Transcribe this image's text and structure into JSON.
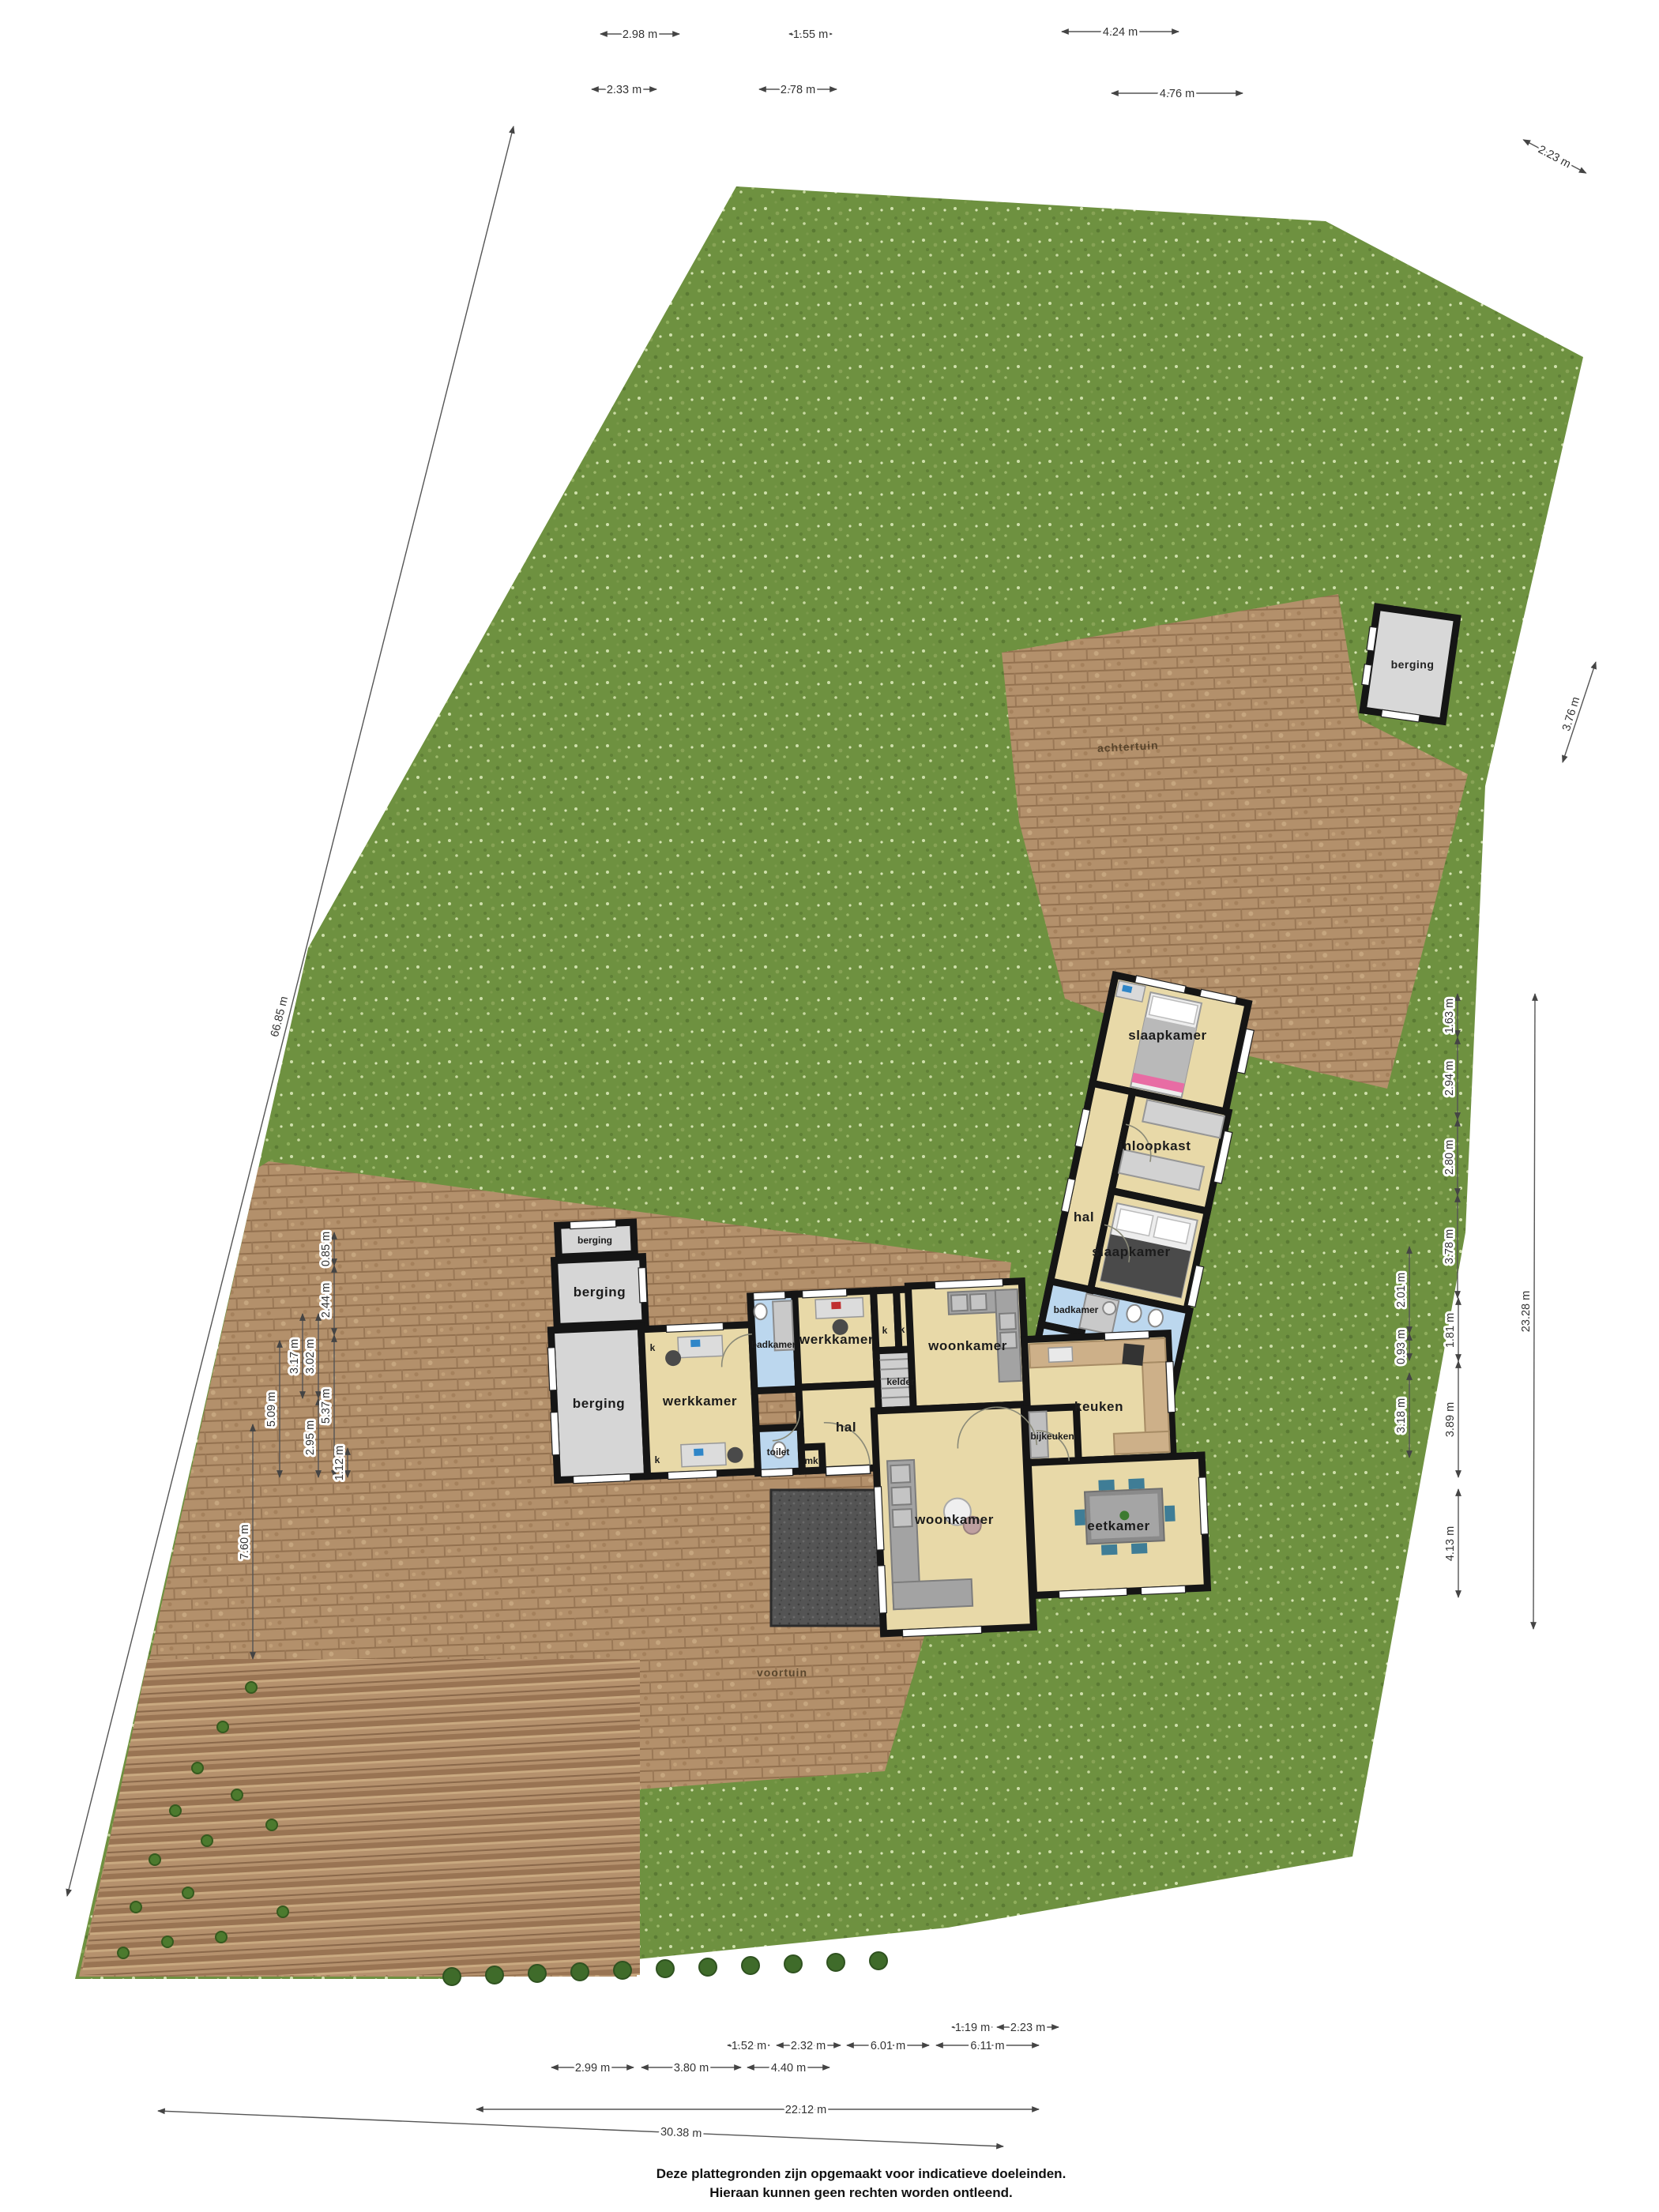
{
  "plan_title": "plattegrond begane grond met tuin",
  "areas": {
    "achtertuin": "achtertuin",
    "voortuin": "voortuin"
  },
  "room_labels": {
    "berging": "berging",
    "werkkamer": "werkkamer",
    "badkamer": "badkamer",
    "kelder": "kelder",
    "hal": "hal",
    "toilet": "toilet",
    "mk": "mk",
    "k": "k",
    "woonkamer": "woonkamer",
    "keuken": "keuken",
    "bijkeuken": "bijkeuken",
    "eetkamer": "eetkamer",
    "slaapkamer": "slaapkamer",
    "inloopkast": "inloopkast"
  },
  "dims": {
    "top": [
      "2.98 m",
      "1.55 m",
      "4.24 m",
      "2.33 m",
      "2.78 m",
      "4.76 m",
      "2.23 m"
    ],
    "left": [
      "66.85 m",
      "7.60 m",
      "5.09 m",
      "3.17 m",
      "3.02 m",
      "2.95 m",
      "0.85 m",
      "2.44 m",
      "5.37 m",
      "1.12 m"
    ],
    "right": [
      "3.76 m",
      "23.28 m",
      "1.63 m",
      "2.94 m",
      "2.80 m",
      "3.78 m",
      "2.01 m",
      "0.93 m",
      "3.18 m",
      "1.81 m",
      "3.89 m",
      "4.13 m"
    ],
    "bottom": [
      "1.19 m",
      "2.23 m",
      "1.52 m",
      "2.32 m",
      "6.01 m",
      "6.11 m",
      "2.99 m",
      "3.80 m",
      "4.40 m",
      "22.12 m",
      "30.38 m"
    ]
  },
  "footer": {
    "line1": "Deze plattegronden zijn opgemaakt voor indicatieve doeleinden.",
    "line2": "Hieraan kunnen geen rechten worden ontleend."
  },
  "colors": {
    "grass": "#6e9140",
    "soil": "#b3906b",
    "floor": "#e8d9a8",
    "storage": "#d6d6d6",
    "bath": "#bcd7ee",
    "wall": "#151515",
    "terrace": "#545454",
    "hedge": "#3f6b2a"
  }
}
